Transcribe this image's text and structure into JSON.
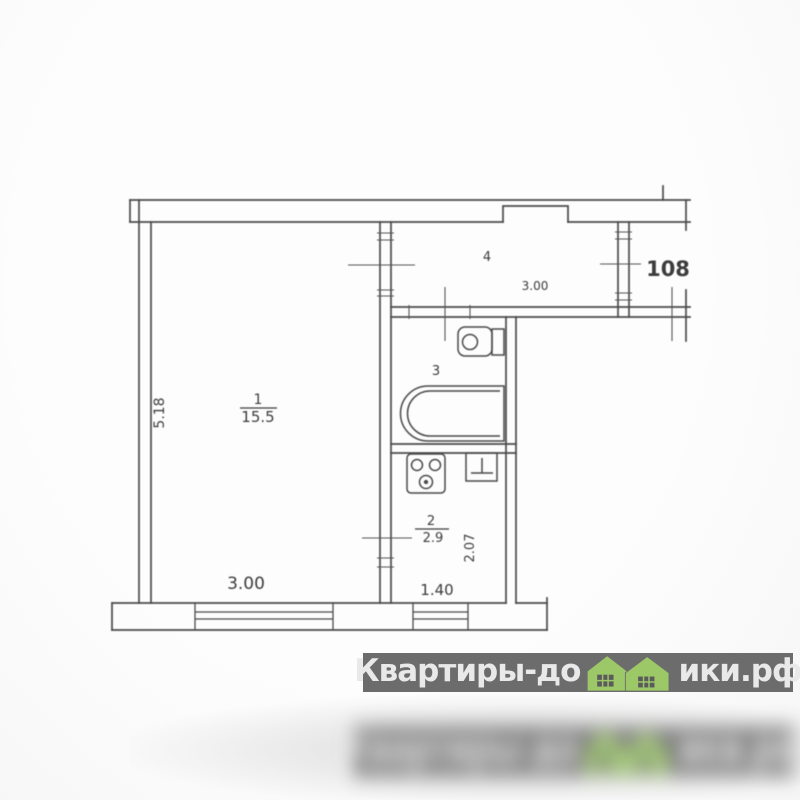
{
  "plan": {
    "apartment_number": "108",
    "rooms": {
      "living": {
        "number": "1",
        "area": "15.5",
        "width": "3.00",
        "depth": "5.18"
      },
      "kitchen": {
        "number": "2",
        "area": "2.9",
        "width": "1.40",
        "depth": "2.07"
      },
      "bathroom": {
        "number": "3"
      },
      "hallway": {
        "number": "4",
        "width": "3.00"
      }
    },
    "line_color": "#4b4b4b",
    "text_color": "#3d3d3d"
  },
  "watermark": {
    "text_before_icon": "Квартиры-до",
    "text_after_icon": "ики.рф",
    "band_color": "#6c6c6c",
    "text_color": "#e9e9e9",
    "house_color": "#9cc868",
    "window_color": "#5b5b5b"
  }
}
